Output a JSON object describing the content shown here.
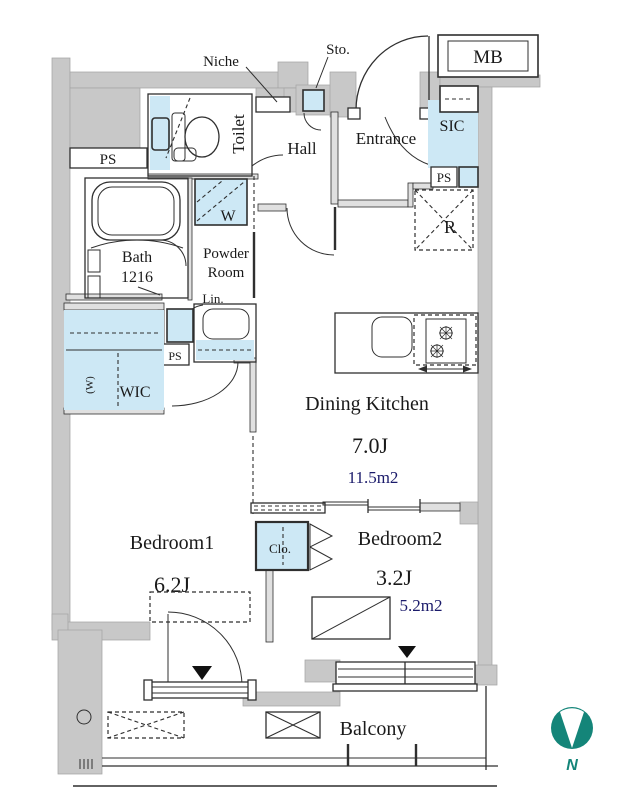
{
  "colors": {
    "wall": "#c8c8c8",
    "wall_edge": "#a5a5a5",
    "iwall": "#e0e0e0",
    "fixture": "#cde8f5",
    "line": "#2f2f2f",
    "label": "#1a1a1a",
    "area_text": "#1b1b6b",
    "compass": "#148579"
  },
  "rooms": {
    "dining_kitchen": {
      "name": "Dining Kitchen",
      "size": "7.0J",
      "area": "11.5m2"
    },
    "bedroom1": {
      "name": "Bedroom1",
      "size": "6.2J",
      "area": "10.2m2"
    },
    "bedroom2": {
      "name": "Bedroom2",
      "size": "3.2J",
      "area": "5.2m2"
    },
    "bath": {
      "name": "Bath",
      "size": "1216"
    },
    "powder": {
      "line1": "Powder",
      "line2": "Room"
    },
    "toilet": "Toilet",
    "hall": "Hall",
    "entrance": "Entrance",
    "wic": "WIC",
    "balcony": "Balcony"
  },
  "labels": {
    "niche": "Niche",
    "sto": "Sto.",
    "mb": "MB",
    "sic": "SIC",
    "ps": "PS",
    "washer": "W",
    "wic_rail": "(W)",
    "lin": "Lin.",
    "refrigerator": "R",
    "closet": "Clo.",
    "north": "N"
  }
}
